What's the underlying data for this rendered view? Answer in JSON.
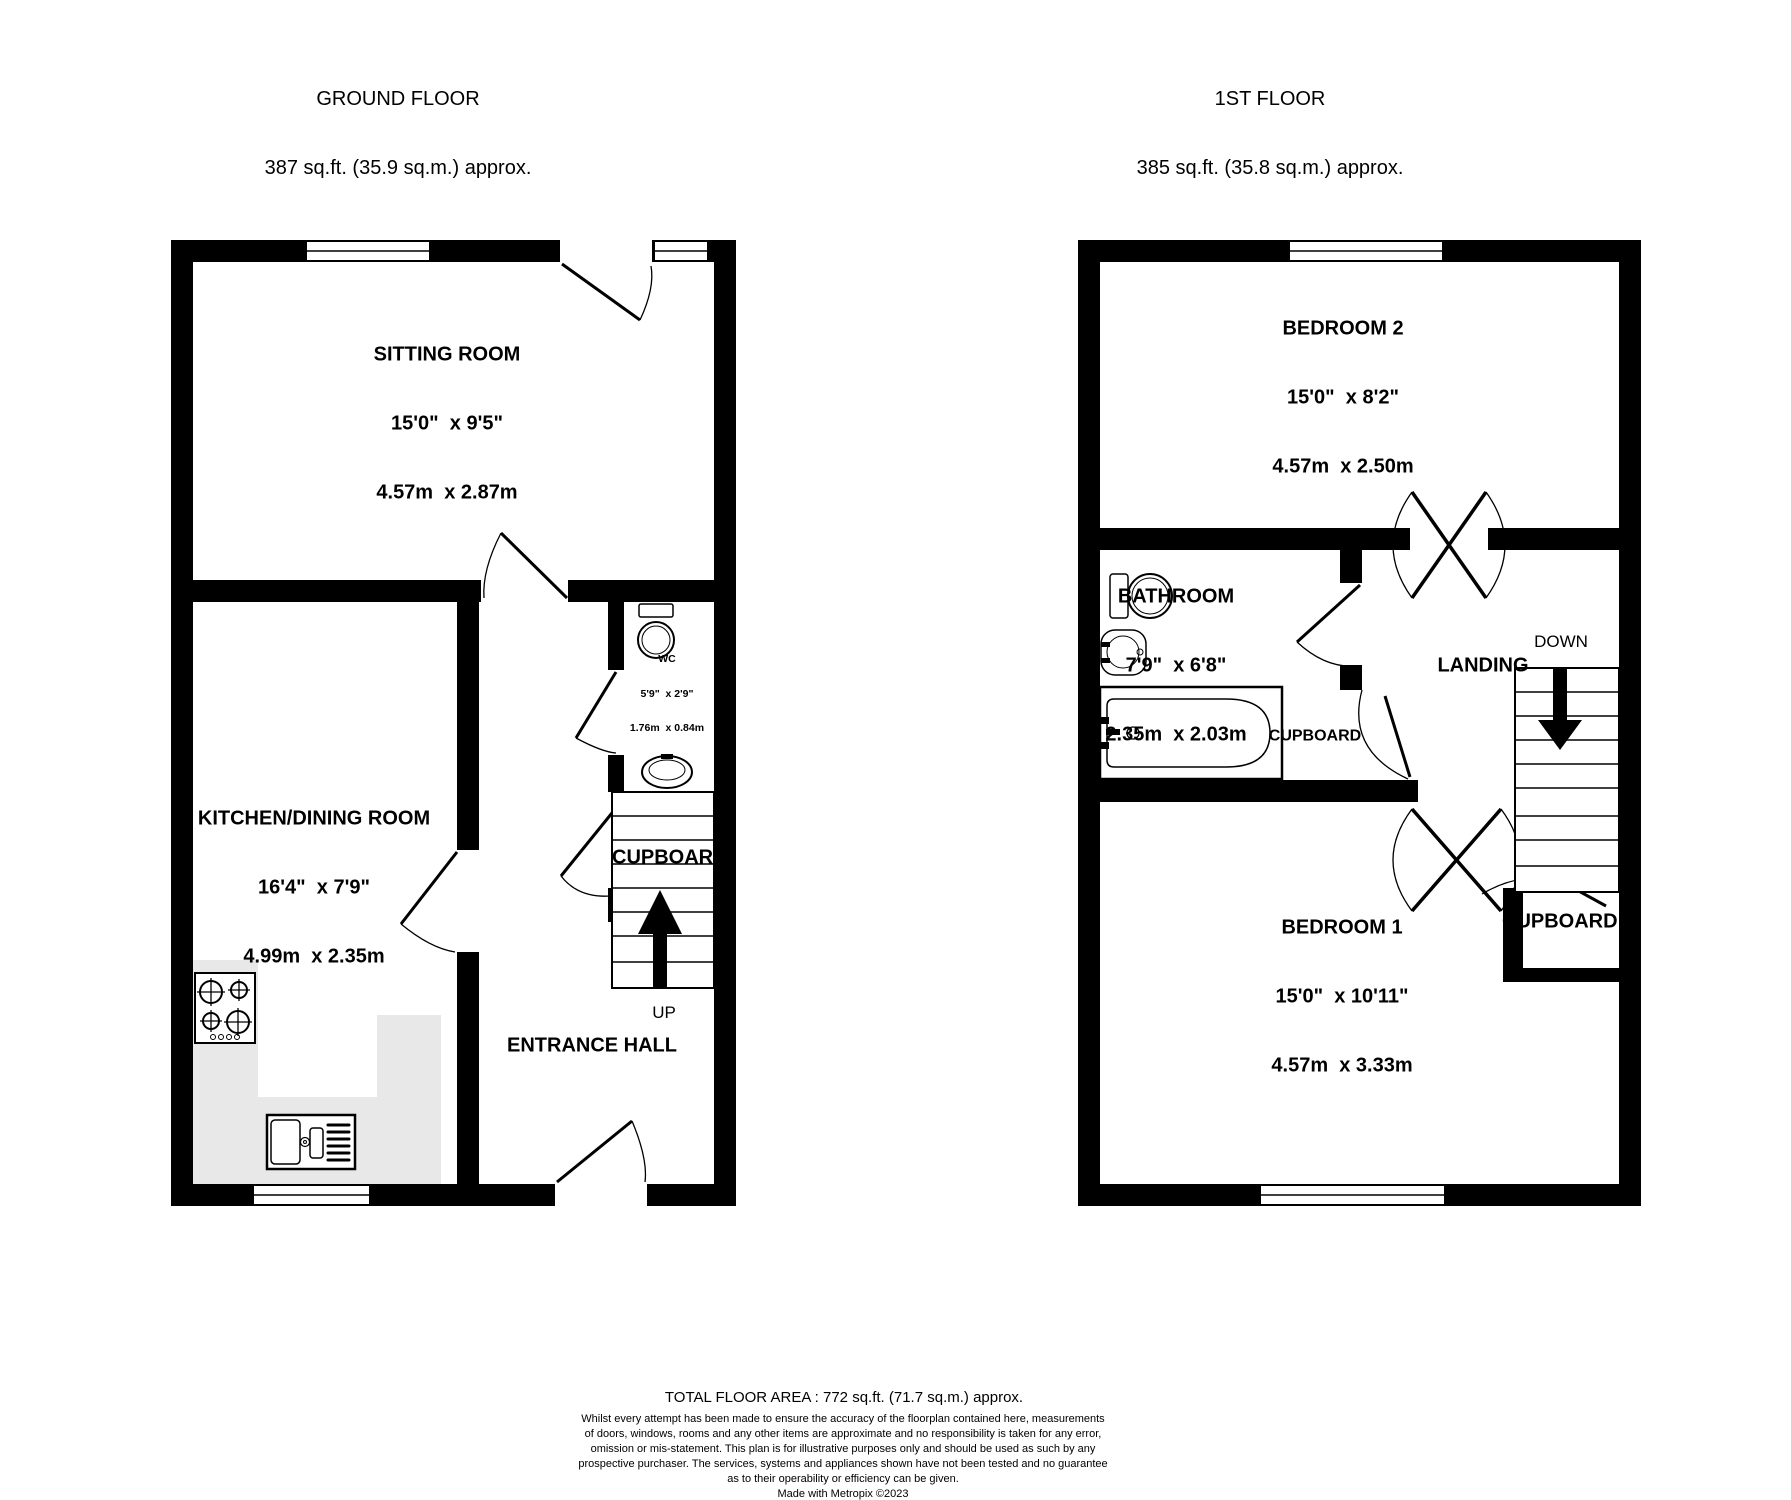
{
  "ground_floor": {
    "title": "GROUND FLOOR",
    "area": "387 sq.ft. (35.9 sq.m.) approx.",
    "sitting_room": {
      "name": "SITTING ROOM",
      "imperial": "15'0\"  x 9'5\"",
      "metric": "4.57m  x 2.87m"
    },
    "kitchen_dining_room": {
      "name": "KITCHEN/DINING ROOM",
      "imperial": "16'4\"  x 7'9\"",
      "metric": "4.99m  x 2.35m"
    },
    "wc": {
      "name": "WC",
      "imperial": "5'9\"  x 2'9\"",
      "metric": "1.76m  x 0.84m"
    },
    "entrance_hall": "ENTRANCE HALL",
    "cupboard": "CUPBOARD",
    "up": "UP"
  },
  "first_floor": {
    "title": "1ST FLOOR",
    "area": "385 sq.ft. (35.8 sq.m.) approx.",
    "bedroom_2": {
      "name": "BEDROOM 2",
      "imperial": "15'0\"  x 8'2\"",
      "metric": "4.57m  x 2.50m"
    },
    "bedroom_1": {
      "name": "BEDROOM 1",
      "imperial": "15'0\"  x 10'11\"",
      "metric": "4.57m  x 3.33m"
    },
    "bathroom": {
      "name": "BATHROOM",
      "imperial": "7'9\"  x 6'8\"",
      "metric": "2.35m  x 2.03m"
    },
    "landing": "LANDING",
    "cupboard_middle": "CUPBOARD",
    "cupboard_lower": "CUPBOARD",
    "down": "DOWN"
  },
  "footer": {
    "total_area": "TOTAL FLOOR AREA : 772 sq.ft. (71.7 sq.m.) approx.",
    "disclaimer_lines": [
      "Whilst every attempt has been made to ensure the accuracy of the floorplan contained here, measurements",
      "of doors, windows, rooms and any other items are approximate and no responsibility is taken for any error,",
      "omission or mis-statement. This plan is for illustrative purposes only and should be used as such by any",
      "prospective purchaser. The services, systems and appliances shown have not been tested and no guarantee",
      "as to their operability or efficiency can be given.",
      "Made with Metropix ©2023"
    ]
  },
  "colors": {
    "wall": "#000000",
    "counter": "#e8e8e8",
    "background": "#ffffff"
  }
}
